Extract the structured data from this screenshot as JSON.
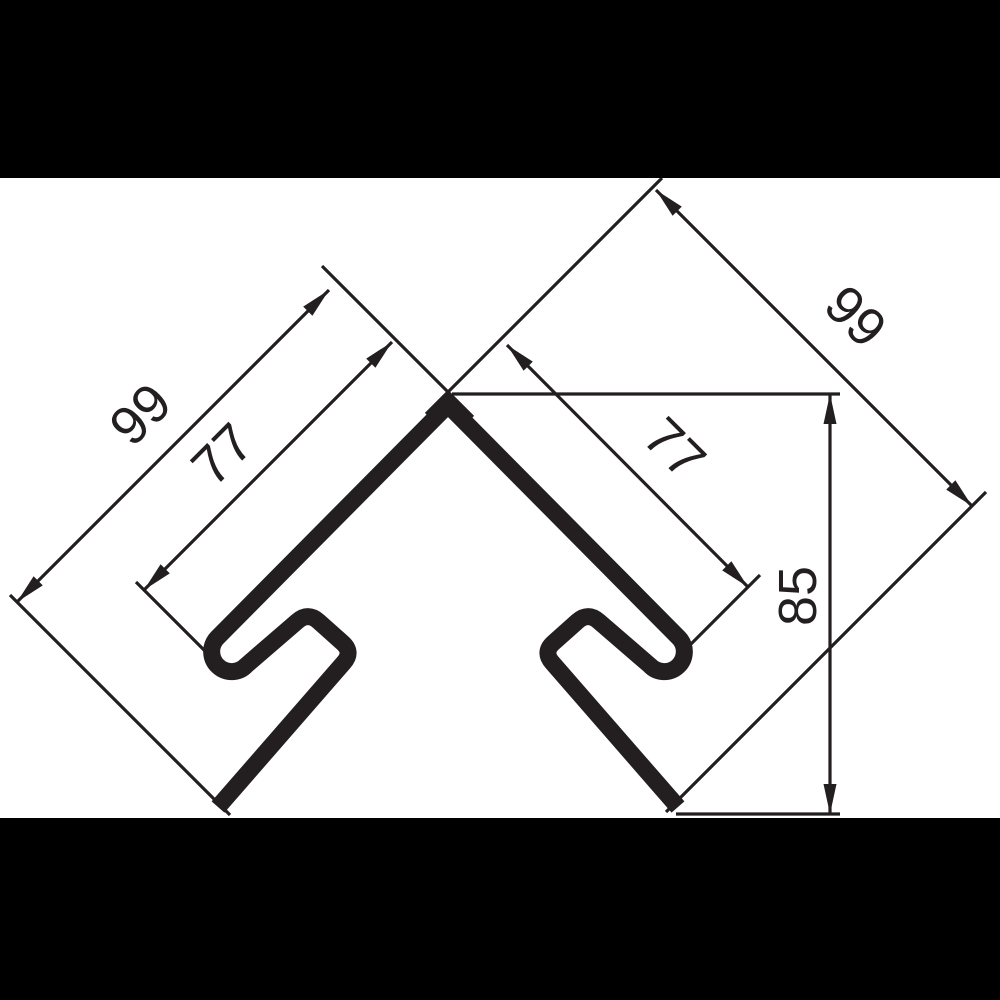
{
  "scene": {
    "description": "Technical cross-section drawing of a corner joint profile with hooked flanges, letterboxed on black",
    "background_color": "#ffffff",
    "letterbox_color": "#000000",
    "ink_color": "#231f20"
  },
  "labels": {
    "left_leg_length": "99",
    "left_hook_length": "77",
    "right_leg_length": "99",
    "right_hook_length": "77",
    "profile_height": "85"
  }
}
